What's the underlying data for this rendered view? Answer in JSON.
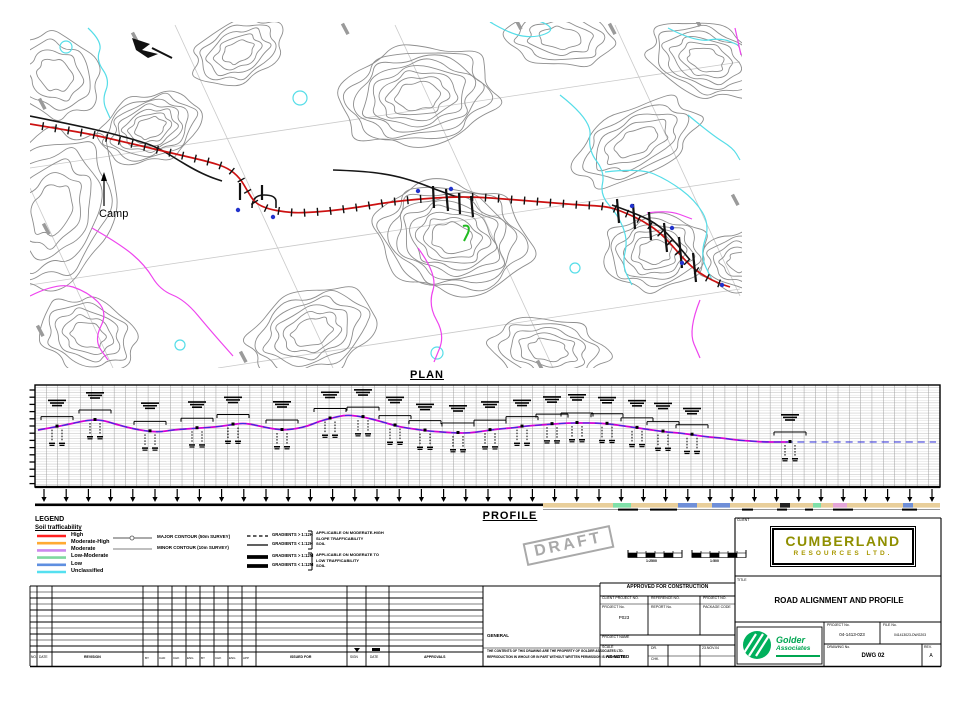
{
  "plan": {
    "label": "PLAN",
    "camp_label": "Camp",
    "colors": {
      "contour": "#8e8e8e",
      "grid": "#c9c9c9",
      "water": "#55dde8",
      "stream": "#ee44ee",
      "road": "#cc1111",
      "existing": "#161616",
      "dot": "#2233cc",
      "marker": "#22bb22",
      "survey_tick": "#9a9a9a"
    },
    "contour_groups": [
      {
        "cx": 150,
        "cy": 128,
        "rx": 52,
        "ry": 34,
        "rot": -18,
        "rings": 7
      },
      {
        "cx": 238,
        "cy": 52,
        "rx": 48,
        "ry": 30,
        "rot": -25,
        "rings": 5
      },
      {
        "cx": 418,
        "cy": 96,
        "rx": 80,
        "ry": 50,
        "rot": -8,
        "rings": 8
      },
      {
        "cx": 560,
        "cy": 38,
        "rx": 55,
        "ry": 28,
        "rot": 5,
        "rings": 4
      },
      {
        "cx": 706,
        "cy": 60,
        "rx": 60,
        "ry": 36,
        "rot": 18,
        "rings": 6
      },
      {
        "cx": 452,
        "cy": 238,
        "rx": 78,
        "ry": 56,
        "rot": 12,
        "rings": 9
      },
      {
        "cx": 655,
        "cy": 252,
        "rx": 52,
        "ry": 38,
        "rot": -6,
        "rings": 6
      },
      {
        "cx": 636,
        "cy": 142,
        "rx": 68,
        "ry": 34,
        "rot": -28,
        "rings": 5
      },
      {
        "cx": 52,
        "cy": 210,
        "rx": 62,
        "ry": 85,
        "rot": 25,
        "rings": 6
      },
      {
        "cx": 312,
        "cy": 332,
        "rx": 66,
        "ry": 42,
        "rot": -20,
        "rings": 6
      },
      {
        "cx": 548,
        "cy": 350,
        "rx": 58,
        "ry": 32,
        "rot": 8,
        "rings": 5
      },
      {
        "cx": 88,
        "cy": 335,
        "rx": 50,
        "ry": 36,
        "rot": 18,
        "rings": 5
      },
      {
        "cx": 55,
        "cy": 75,
        "rx": 48,
        "ry": 40,
        "rot": 30,
        "rings": 4
      },
      {
        "cx": 742,
        "cy": 262,
        "rx": 42,
        "ry": 30,
        "rot": 0,
        "rings": 5
      }
    ],
    "grid_lines": [
      [
        175,
        25,
        333,
        368
      ],
      [
        395,
        25,
        553,
        368
      ],
      [
        615,
        25,
        740,
        296
      ],
      [
        30,
        188,
        113,
        368
      ],
      [
        30,
        168,
        740,
        62
      ],
      [
        30,
        285,
        740,
        179
      ],
      [
        218,
        368,
        740,
        289
      ]
    ],
    "cyan_paths": [
      [
        [
          88,
          28
        ],
        [
          103,
          42
        ],
        [
          96,
          60
        ],
        [
          110,
          80
        ],
        [
          102,
          100
        ],
        [
          110,
          118
        ]
      ],
      [
        [
          560,
          95
        ],
        [
          592,
          120
        ],
        [
          588,
          150
        ],
        [
          605,
          172
        ],
        [
          600,
          195
        ],
        [
          618,
          215
        ],
        [
          628,
          240
        ],
        [
          622,
          265
        ],
        [
          632,
          285
        ]
      ],
      [
        [
          605,
          172
        ],
        [
          640,
          168
        ],
        [
          668,
          180
        ],
        [
          695,
          200
        ],
        [
          710,
          225
        ],
        [
          700,
          255
        ],
        [
          712,
          280
        ]
      ],
      [
        [
          688,
          115
        ],
        [
          712,
          135
        ],
        [
          733,
          148
        ],
        [
          740,
          160
        ]
      ],
      [
        [
          668,
          28
        ],
        [
          695,
          42
        ],
        [
          722,
          38
        ],
        [
          738,
          45
        ]
      ],
      [
        [
          490,
          22
        ],
        [
          510,
          34
        ],
        [
          535,
          38
        ],
        [
          555,
          30
        ],
        [
          540,
          20
        ],
        [
          512,
          18
        ],
        [
          490,
          22
        ]
      ]
    ],
    "ponds": [
      [
        300,
        98,
        7
      ],
      [
        575,
        268,
        5
      ],
      [
        437,
        353,
        6
      ],
      [
        66,
        47,
        6
      ],
      [
        180,
        345,
        5
      ]
    ],
    "magenta_paths": [
      [
        [
          30,
          296
        ],
        [
          58,
          282
        ],
        [
          88,
          292
        ],
        [
          108,
          312
        ],
        [
          94,
          340
        ],
        [
          108,
          360
        ]
      ],
      [
        [
          92,
          228
        ],
        [
          120,
          244
        ],
        [
          145,
          265
        ],
        [
          160,
          290
        ],
        [
          185,
          300
        ],
        [
          210,
          330
        ],
        [
          233,
          356
        ]
      ],
      [
        [
          418,
          248
        ],
        [
          438,
          275
        ],
        [
          428,
          305
        ],
        [
          445,
          335
        ],
        [
          434,
          362
        ]
      ],
      [
        [
          647,
          213
        ],
        [
          668,
          210
        ],
        [
          692,
          219
        ]
      ],
      [
        [
          700,
          300
        ],
        [
          688,
          330
        ],
        [
          700,
          358
        ]
      ],
      [
        [
          735,
          28
        ],
        [
          741,
          55
        ]
      ]
    ],
    "road_points": [
      [
        30,
        124
      ],
      [
        60,
        129
      ],
      [
        90,
        134
      ],
      [
        120,
        141
      ],
      [
        150,
        148
      ],
      [
        180,
        155
      ],
      [
        210,
        162
      ],
      [
        228,
        168
      ],
      [
        240,
        178
      ],
      [
        248,
        192
      ],
      [
        255,
        203
      ],
      [
        268,
        209
      ],
      [
        285,
        212
      ],
      [
        300,
        213
      ],
      [
        330,
        211
      ],
      [
        360,
        207
      ],
      [
        390,
        202
      ],
      [
        420,
        199
      ],
      [
        450,
        197
      ],
      [
        477,
        197
      ],
      [
        505,
        199
      ],
      [
        530,
        201
      ],
      [
        555,
        203
      ],
      [
        580,
        205
      ],
      [
        600,
        206
      ],
      [
        613,
        208
      ],
      [
        628,
        214
      ],
      [
        643,
        221
      ],
      [
        658,
        231
      ],
      [
        670,
        243
      ],
      [
        682,
        257
      ],
      [
        694,
        269
      ],
      [
        706,
        277
      ],
      [
        718,
        283
      ],
      [
        730,
        287
      ]
    ],
    "black_segments": [
      [
        [
          30,
          116
        ],
        [
          70,
          124
        ],
        [
          110,
          133
        ],
        [
          146,
          143
        ],
        [
          162,
          150
        ],
        [
          178,
          160
        ],
        [
          195,
          170
        ],
        [
          210,
          177
        ],
        [
          222,
          181
        ]
      ],
      [
        [
          333,
          170
        ],
        [
          362,
          171
        ],
        [
          392,
          175
        ],
        [
          417,
          182
        ],
        [
          437,
          190
        ],
        [
          457,
          197
        ]
      ],
      [
        [
          612,
          205
        ],
        [
          640,
          215
        ],
        [
          660,
          226
        ],
        [
          676,
          243
        ],
        [
          690,
          260
        ]
      ],
      [
        [
          252,
          208
        ],
        [
          252,
          195
        ],
        [
          276,
          195
        ],
        [
          276,
          208
        ]
      ]
    ],
    "culvert_strokes": [
      [
        433,
        186,
        434,
        208
      ],
      [
        446,
        189,
        448,
        211
      ],
      [
        459,
        193,
        460,
        214
      ],
      [
        471,
        196,
        473,
        217
      ],
      [
        617,
        199,
        619,
        223
      ],
      [
        633,
        204,
        635,
        229
      ],
      [
        649,
        212,
        651,
        240
      ],
      [
        664,
        223,
        667,
        252
      ],
      [
        679,
        237,
        682,
        268
      ],
      [
        693,
        253,
        696,
        282
      ],
      [
        240,
        183,
        240,
        200
      ],
      [
        262,
        185,
        262,
        200
      ]
    ],
    "blue_dots": [
      [
        238,
        210
      ],
      [
        273,
        217
      ],
      [
        418,
        191
      ],
      [
        451,
        189
      ],
      [
        632,
        206
      ],
      [
        672,
        228
      ],
      [
        682,
        263
      ],
      [
        722,
        285
      ]
    ],
    "green_marker": [
      463,
      226
    ],
    "survey_ticks": [
      [
        42,
        104
      ],
      [
        135,
        38
      ],
      [
        345,
        29
      ],
      [
        518,
        24
      ],
      [
        612,
        29
      ],
      [
        697,
        21
      ],
      [
        46,
        229
      ],
      [
        40,
        331
      ],
      [
        243,
        357
      ],
      [
        735,
        200
      ],
      [
        540,
        366
      ]
    ]
  },
  "profile": {
    "label": "PROFILE",
    "frame": {
      "x": 35,
      "y": 385,
      "w": 905,
      "h": 102
    },
    "ground_points": [
      [
        38,
        430
      ],
      [
        55,
        427
      ],
      [
        70,
        424
      ],
      [
        88,
        420
      ],
      [
        102,
        420
      ],
      [
        115,
        424
      ],
      [
        130,
        428
      ],
      [
        145,
        431
      ],
      [
        160,
        432
      ],
      [
        172,
        430
      ],
      [
        185,
        429
      ],
      [
        200,
        428
      ],
      [
        215,
        427
      ],
      [
        230,
        425
      ],
      [
        243,
        423
      ],
      [
        255,
        425
      ],
      [
        268,
        428
      ],
      [
        282,
        430
      ],
      [
        295,
        429
      ],
      [
        308,
        426
      ],
      [
        320,
        421
      ],
      [
        332,
        418
      ],
      [
        345,
        415
      ],
      [
        358,
        416
      ],
      [
        372,
        419
      ],
      [
        386,
        423
      ],
      [
        400,
        427
      ],
      [
        414,
        429
      ],
      [
        428,
        431
      ],
      [
        442,
        432
      ],
      [
        456,
        433
      ],
      [
        470,
        433
      ],
      [
        484,
        431
      ],
      [
        498,
        429
      ],
      [
        512,
        428
      ],
      [
        526,
        426
      ],
      [
        540,
        425
      ],
      [
        554,
        424
      ],
      [
        568,
        423
      ],
      [
        582,
        423
      ],
      [
        596,
        423
      ],
      [
        610,
        424
      ],
      [
        624,
        426
      ],
      [
        638,
        428
      ],
      [
        652,
        430
      ],
      [
        666,
        432
      ],
      [
        680,
        433
      ],
      [
        694,
        435
      ],
      [
        708,
        437
      ],
      [
        722,
        438
      ],
      [
        736,
        440
      ],
      [
        750,
        441
      ],
      [
        764,
        442
      ],
      [
        778,
        442
      ],
      [
        788,
        442
      ]
    ],
    "design_extra_points": [
      [
        800,
        442
      ],
      [
        820,
        442
      ],
      [
        845,
        442
      ],
      [
        870,
        442
      ],
      [
        895,
        442
      ],
      [
        918,
        442
      ],
      [
        936,
        442
      ]
    ],
    "annotation_x": [
      57,
      95,
      150,
      197,
      233,
      282,
      330,
      363,
      395,
      425,
      458,
      490,
      522,
      552,
      577,
      607,
      637,
      663,
      692,
      790
    ],
    "arrows": {
      "x0": 44,
      "step": 22.2,
      "count": 41,
      "y": 489
    },
    "strip": {
      "black_end": 543,
      "tan_color": "#e9cf9b",
      "segments": [
        {
          "x": 613,
          "w": 18,
          "c": "#7fe0a8"
        },
        {
          "x": 678,
          "w": 19,
          "c": "#6f8fd8"
        },
        {
          "x": 712,
          "w": 18,
          "c": "#6f8fd8"
        },
        {
          "x": 780,
          "w": 10,
          "c": "#222222"
        },
        {
          "x": 813,
          "w": 8,
          "c": "#7fe0a8"
        },
        {
          "x": 833,
          "w": 14,
          "c": "#e5a6d8"
        },
        {
          "x": 903,
          "w": 10,
          "c": "#6f8fd8"
        }
      ],
      "under_segments": [
        [
          618,
          20
        ],
        [
          650,
          27
        ],
        [
          742,
          11
        ],
        [
          777,
          10
        ],
        [
          805,
          8
        ],
        [
          833,
          20
        ],
        [
          902,
          15
        ]
      ]
    }
  },
  "legend": {
    "title": "LEGEND",
    "subtitle": "Soil trafficability",
    "trafficability": [
      {
        "color": "#ff2020",
        "label": "High"
      },
      {
        "color": "#ffaa33",
        "label": "Moderate-High"
      },
      {
        "color": "#cc88ee",
        "label": "Moderate"
      },
      {
        "color": "#7fd89f",
        "label": "Low-Moderate"
      },
      {
        "color": "#5f8fe0",
        "label": "Low"
      },
      {
        "color": "#55e0f0",
        "label": "Unclassified"
      }
    ],
    "contours": [
      {
        "style": "major",
        "label": "MAJOR CONTOUR (50m SURVEY)"
      },
      {
        "style": "minor",
        "label": "MINOR CONTOUR (10m SURVEY)"
      }
    ],
    "gradients": [
      {
        "style": "dashed-thin",
        "label": "GRADIENTS > 1:12H"
      },
      {
        "style": "thin",
        "label": "GRADIENTS < 1:12H"
      },
      {
        "style": "thick",
        "label": "GRADIENTS > 1:12M"
      },
      {
        "style": "thick",
        "label": "GRADIENTS < 1:12M"
      }
    ],
    "gradient_notes": [
      [
        "APPLICABLE ON MODERATE-HIGH",
        "SLOPE TRAFFICABILITY",
        "SOIL"
      ],
      [
        "APPLICABLE ON MODERATE TO",
        "LOW TRAFFICABILITY",
        "SOIL"
      ]
    ]
  },
  "stamp": {
    "text": "DRAFT"
  },
  "scale_bars": [
    {
      "label": "1:2500"
    },
    {
      "label": "1:500"
    }
  ],
  "approval": {
    "header": "APPROVED FOR CONSTRUCTION",
    "row_labels": [
      "CLIENT PROJECT NO.",
      "REFERENCE NO.",
      "PROJECT NO."
    ],
    "cells": [
      {
        "label": "PROJECT No.",
        "value": "P023"
      },
      {
        "label": "REPORT No.",
        "value": ""
      },
      {
        "label": "PACKAGE CODE",
        "value": ""
      }
    ],
    "project_name_label": "PROJECT NAME",
    "scale_label": "SCALE",
    "scale_value": "AS NOTED",
    "sign_rows": [
      [
        "DR.",
        "",
        "23.NOV.04"
      ],
      [
        "CHK.",
        "",
        ""
      ]
    ]
  },
  "disclaimer": {
    "heading": "GENERAL",
    "line1": "THE CONTENTS OF THIS DRAWING ARE THE PROPERTY OF GOLDER ASSOCIATES LTD.",
    "line2": "REPRODUCTION IN WHOLE OR IN PART WITHOUT WRITTEN PERMISSION IS PROHIBITED."
  },
  "revision_table": {
    "left_labels": [
      "NO.",
      "DATE"
    ],
    "revision_label": "REVISION",
    "narrow_labels": [
      "BY",
      "CAD",
      "CHK",
      "ENG",
      "BY",
      "CHK",
      "ENG",
      "APP"
    ],
    "issued_label": "ISSUED FOR",
    "cell_labels": [
      "SIGN",
      "DATE"
    ],
    "approvals_label": "APPROVALS"
  },
  "title_block": {
    "client_label": "CLIENT",
    "company_line1": "CUMBERLAND",
    "company_line2": "RESOURCES LTD.",
    "title_label": "TITLE",
    "title": "ROAD ALIGNMENT AND PROFILE",
    "golder_line1": "Golder",
    "golder_line2": "Associates",
    "project_no_label": "PROJECT No.",
    "project_no": "04-1413-023",
    "file_no_label": "FILE No.",
    "file_no": "041413023-DWG203",
    "drawing_no_label": "DRAWING No.",
    "drawing_no": "DWG 02",
    "rev_label": "REV.",
    "rev": "A"
  }
}
